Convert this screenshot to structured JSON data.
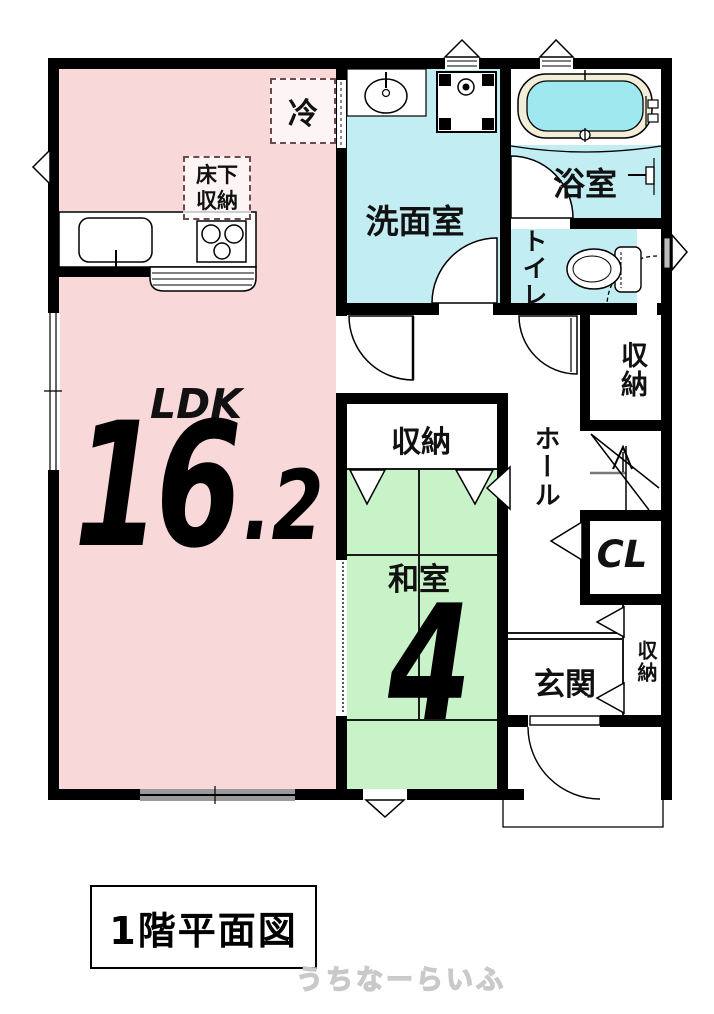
{
  "labels": {
    "ldk": "LDK",
    "ldk_size_int": "16",
    "ldk_size_dec": ".2",
    "washroom": "洗面室",
    "bath": "浴室",
    "toilet": "トイレ",
    "hall": "ホール",
    "closet_upper": "収納",
    "cl": "CL",
    "washitsu_closet": "収納",
    "washitsu": "和室",
    "washitsu_size": "4",
    "genkan": "玄関",
    "genkan_closet": "収納",
    "fridge": "冷",
    "underfloor_storage": "床下収納",
    "plan_title": "1階平面図",
    "watermark": "うちなーらいふ"
  },
  "colors": {
    "ldk": "#f8d8d8",
    "wet": "#c2edf2",
    "tatami": "#c8f3c8",
    "tub_ring": "#f2eed8",
    "tub_water": "#a0e8ef",
    "wall": "#000000",
    "watermark": "#c9c9c9"
  }
}
